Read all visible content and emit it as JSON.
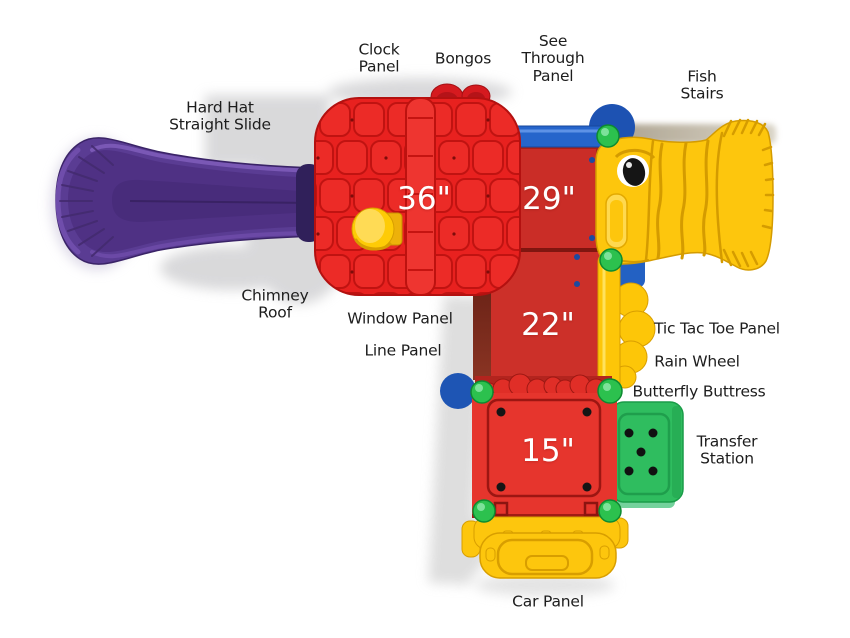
{
  "figure": {
    "type": "playground-structure-top-view-diagram",
    "background": "#ffffff"
  },
  "labels": {
    "hard_hat_straight_slide": "Hard Hat\nStraight Slide",
    "clock_panel": "Clock\nPanel",
    "bongos": "Bongos",
    "see_through_panel": "See\nThrough\nPanel",
    "fish_stairs": "Fish\nStairs",
    "chimney_roof": "Chimney\nRoof",
    "window_panel": "Window Panel",
    "line_panel": "Line Panel",
    "tic_tac_toe_panel": "Tic Tac Toe Panel",
    "rain_wheel": "Rain Wheel",
    "butterfly_buttress": "Butterfly Buttress",
    "transfer_station": "Transfer\nStation",
    "car_panel": "Car Panel"
  },
  "deck_heights": {
    "roof_deck": "36\"",
    "upper_deck": "29\"",
    "middle_deck": "22\"",
    "lower_deck": "15\""
  },
  "colors": {
    "roof_red": "#e8211f",
    "deck_red": "#cc3029",
    "bright_red": "#e6352d",
    "yellow": "#fdc60d",
    "blue": "#2361c3",
    "green_ball": "#2cc14e",
    "transfer_green": "#2fbd5f",
    "slide_purple": "#5a3c93",
    "label_text": "#1d1d1d",
    "dimension_text": "#ffffff"
  }
}
